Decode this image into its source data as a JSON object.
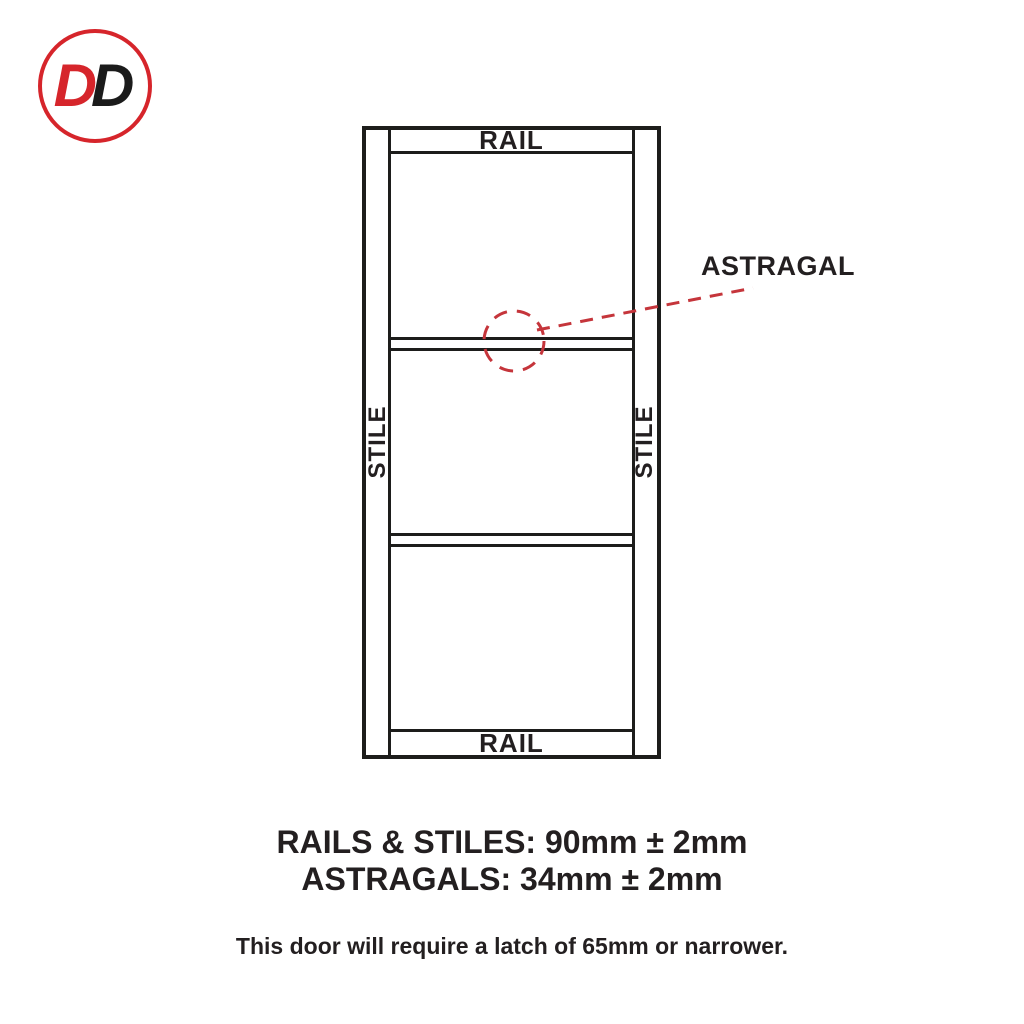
{
  "logo": {
    "letter_1": "D",
    "letter_2": "D"
  },
  "diagram": {
    "top_rail_label": "RAIL",
    "bottom_rail_label": "RAIL",
    "left_stile_label": "STILE",
    "right_stile_label": "STILE",
    "astragal_label": "ASTRAGAL"
  },
  "specs": {
    "rails_stiles": "RAILS & STILES: 90mm ± 2mm",
    "astragals": "ASTRAGALS: 34mm ± 2mm",
    "latch_note": "This door will require a latch of 65mm or narrower."
  },
  "colors": {
    "brand_red": "#d6252b",
    "diagram_line": "#1d1d1b",
    "callout_red": "#c5353b",
    "text_dark": "#231f20"
  }
}
